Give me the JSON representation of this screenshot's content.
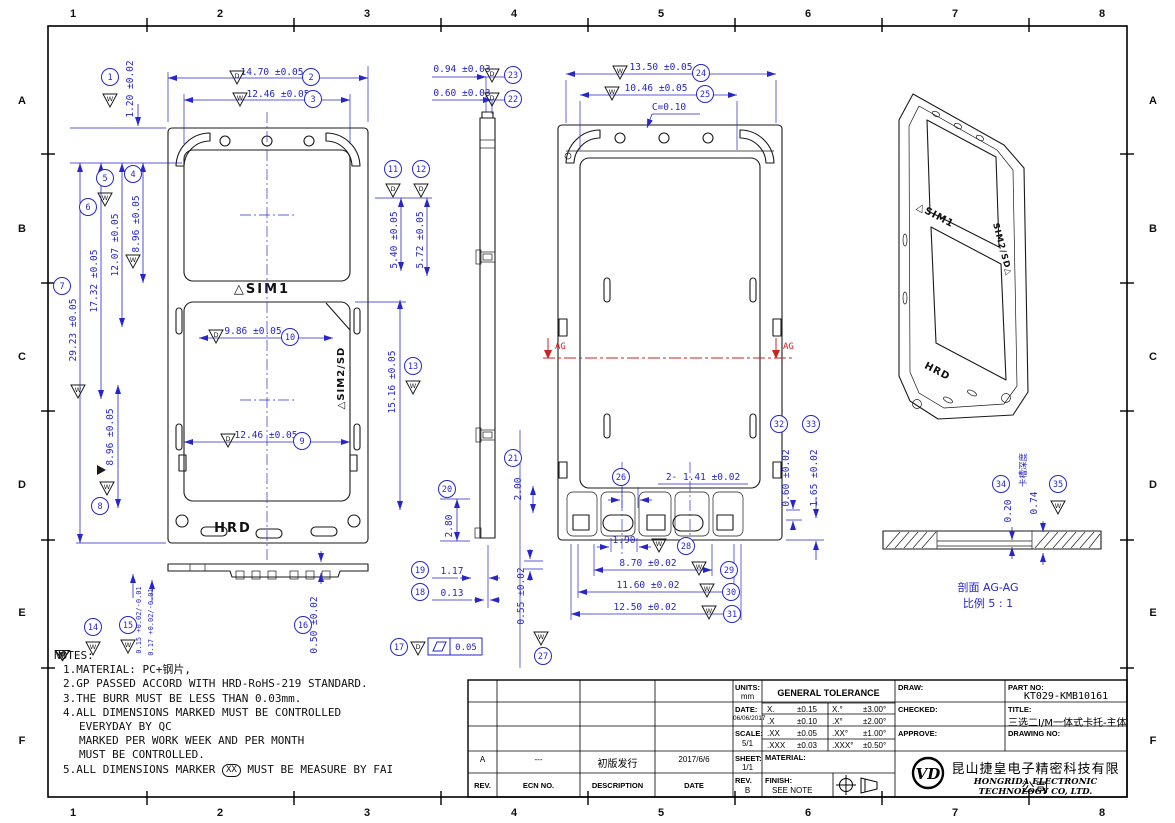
{
  "sheet": {
    "zone_cols": [
      "1",
      "2",
      "3",
      "4",
      "5",
      "6",
      "7",
      "8"
    ],
    "zone_rows": [
      "A",
      "B",
      "C",
      "D",
      "E",
      "F"
    ]
  },
  "colors": {
    "dimension_blue": "#2626cc",
    "line_black": "#1a1a1a",
    "section_red": "#cc2222"
  },
  "views": {
    "front": {
      "sim1_label": "△SIM1",
      "sim2sd_label": "△SIM2/SD",
      "brand_label": "HRD"
    },
    "rear": {
      "chamfer_note": "C=0.10",
      "section_mark_left": "AG",
      "section_mark_right": "AG"
    },
    "iso": {
      "sim1_label": "△SIM1",
      "sim2sd_label": "SIM2/SD△",
      "brand_label": "HRD"
    },
    "section": {
      "caption_title": "剖面 AG-AG",
      "caption_scale": "比例 5 : 1"
    }
  },
  "dims": {
    "d1": {
      "n": "1",
      "t": "1.20 ±0.02",
      "m": "W"
    },
    "d2": {
      "n": "2",
      "t": "14.70 ±0.05",
      "m": "D"
    },
    "d3": {
      "n": "3",
      "t": "12.46 ±0.05",
      "m": "W"
    },
    "d4": {
      "n": "4",
      "t": "8.96 ±0.05",
      "m": "W"
    },
    "d5": {
      "n": "5",
      "t": "12.07 ±0.05",
      "m": "W"
    },
    "d6": {
      "n": "6",
      "t": "17.32 ±0.05"
    },
    "d7": {
      "n": "7",
      "t": "29.23 ±0.05",
      "m": "W"
    },
    "d8": {
      "n": "8",
      "t": "8.96 ±0.05",
      "m": "W"
    },
    "d9": {
      "n": "9",
      "t": "12.46 ±0.05",
      "m": "D"
    },
    "d10": {
      "n": "10",
      "t": "9.86 ±0.05",
      "m": "D"
    },
    "d11": {
      "n": "11",
      "t": "5.40 ±0.05",
      "m": "D"
    },
    "d12": {
      "n": "12",
      "t": "5.72 ±0.05",
      "m": "D"
    },
    "d13": {
      "n": "13",
      "t": "15.16 ±0.05",
      "m": "W"
    },
    "d14": {
      "n": "14",
      "t": "0.15 +0.02/-0.01",
      "m": "W"
    },
    "d15": {
      "n": "15",
      "t": "0.17 +0.02/-0.01",
      "m": "W"
    },
    "d16": {
      "n": "16",
      "t": "0.50 ±0.02"
    },
    "d17": {
      "n": "17",
      "m": "D",
      "v": "0.05"
    },
    "d18": {
      "n": "18",
      "t": "0.13"
    },
    "d19": {
      "n": "19",
      "t": "1.17"
    },
    "d20": {
      "n": "20",
      "t": "2.80"
    },
    "d21": {
      "n": "21",
      "t": "2.00"
    },
    "d22": {
      "n": "22",
      "t": "0.60 ±0.03",
      "m": "D"
    },
    "d23": {
      "n": "23",
      "t": "0.94 ±0.03",
      "m": "D"
    },
    "d24": {
      "n": "24",
      "t": "13.50 ±0.05",
      "m": "W"
    },
    "d25": {
      "n": "25",
      "t": "10.46 ±0.05",
      "m": "W"
    },
    "d26": {
      "n": "26",
      "t": "2- 1.41 ±0.02"
    },
    "d27": {
      "n": "27",
      "t": "0.55 ±0.02",
      "m": "W"
    },
    "d28": {
      "n": "28",
      "t": "1.90",
      "m": "W"
    },
    "d29": {
      "n": "29",
      "t": "8.70 ±0.02",
      "m": "W"
    },
    "d30": {
      "n": "30",
      "t": "11.60 ±0.02",
      "m": "W"
    },
    "d31": {
      "n": "31",
      "t": "12.50 ±0.02",
      "m": "W"
    },
    "d32": {
      "n": "32",
      "t": "0.60 ±0.02"
    },
    "d33": {
      "n": "33",
      "t": "1.65 ±0.02"
    },
    "d34": {
      "n": "34",
      "t": "0.20"
    },
    "d35": {
      "n": "35",
      "t": "0.74",
      "label": "卡槽深度",
      "m": "W"
    }
  },
  "notes": {
    "heading": "NOTES:",
    "n1": "1.MATERIAL: PC+钢片,",
    "n2": "2.GP PASSED ACCORD WITH HRD-RoHS-219 STANDARD.",
    "n3": "3.THE BURR MUST BE LESS THAN 0.03mm.",
    "n4a": "4.ALL DIMENSIONS MARKED",
    "n4b": "MUST BE CONTROLLED",
    "n4c": "EVERYDAY BY QC",
    "n4d": "MARKED",
    "n4e": "PER WORK WEEK AND",
    "n4f": "PER MONTH",
    "n4g": "MUST BE CONTROLLED.",
    "n5a": "5.ALL DIMENSIONS MARKER",
    "n5b": "XX",
    "n5c": "MUST BE MEASURE BY FAI",
    "mark_daily": "D",
    "mark_weekly": "W",
    "mark_monthly": "M"
  },
  "revisions": {
    "headers": {
      "rev": "REV.",
      "ecn": "ECN NO.",
      "desc": "DESCRIPTION",
      "date": "DATE"
    },
    "rows": [
      {
        "rev": "A",
        "ecn": "---",
        "desc": "初版发行",
        "date": "2017/6/6"
      }
    ]
  },
  "titleblock": {
    "units_label": "UNITS:",
    "units_value": "mm",
    "tolerance_title": "GENERAL TOLERANCE",
    "tolerances": [
      {
        "k1": "X.",
        "v1": "±0.15",
        "k2": "X.°",
        "v2": "±3.00°"
      },
      {
        "k1": ".X",
        "v1": "±0.10",
        "k2": ".X°",
        "v2": "±2.00°"
      },
      {
        "k1": ".XX",
        "v1": "±0.05",
        "k2": ".XX°",
        "v2": "±1.00°"
      },
      {
        "k1": ".XXX",
        "v1": "±0.03",
        "k2": ".XXX°",
        "v2": "±0.50°"
      }
    ],
    "date_label": "DATE:",
    "date_value": "06/06/2017",
    "scale_label": "SCALE:",
    "scale_value": "5/1",
    "sheet_label": "SHEET:",
    "sheet_value": "1/1",
    "rev_label": "REV.",
    "rev_value": "B",
    "material_label": "MATERIAL:",
    "finish_label": "FINISH:",
    "finish_value": "SEE NOTE",
    "draw_label": "DRAW:",
    "checked_label": "CHECKED:",
    "approve_label": "APPROVE:",
    "part_no_label": "PART NO:",
    "part_no_value": "KT029-KMB10161",
    "title_label": "TITLE:",
    "title_value": "三选二I/M一体式卡托-主体",
    "drawing_no_label": "DRAWING NO:",
    "logo_text": "VD",
    "company_cn": "昆山捷皇电子精密科技有限公司",
    "company_en": "HONGRIDA ELECTRONIC TECHNOLOGY CO, LTD."
  }
}
